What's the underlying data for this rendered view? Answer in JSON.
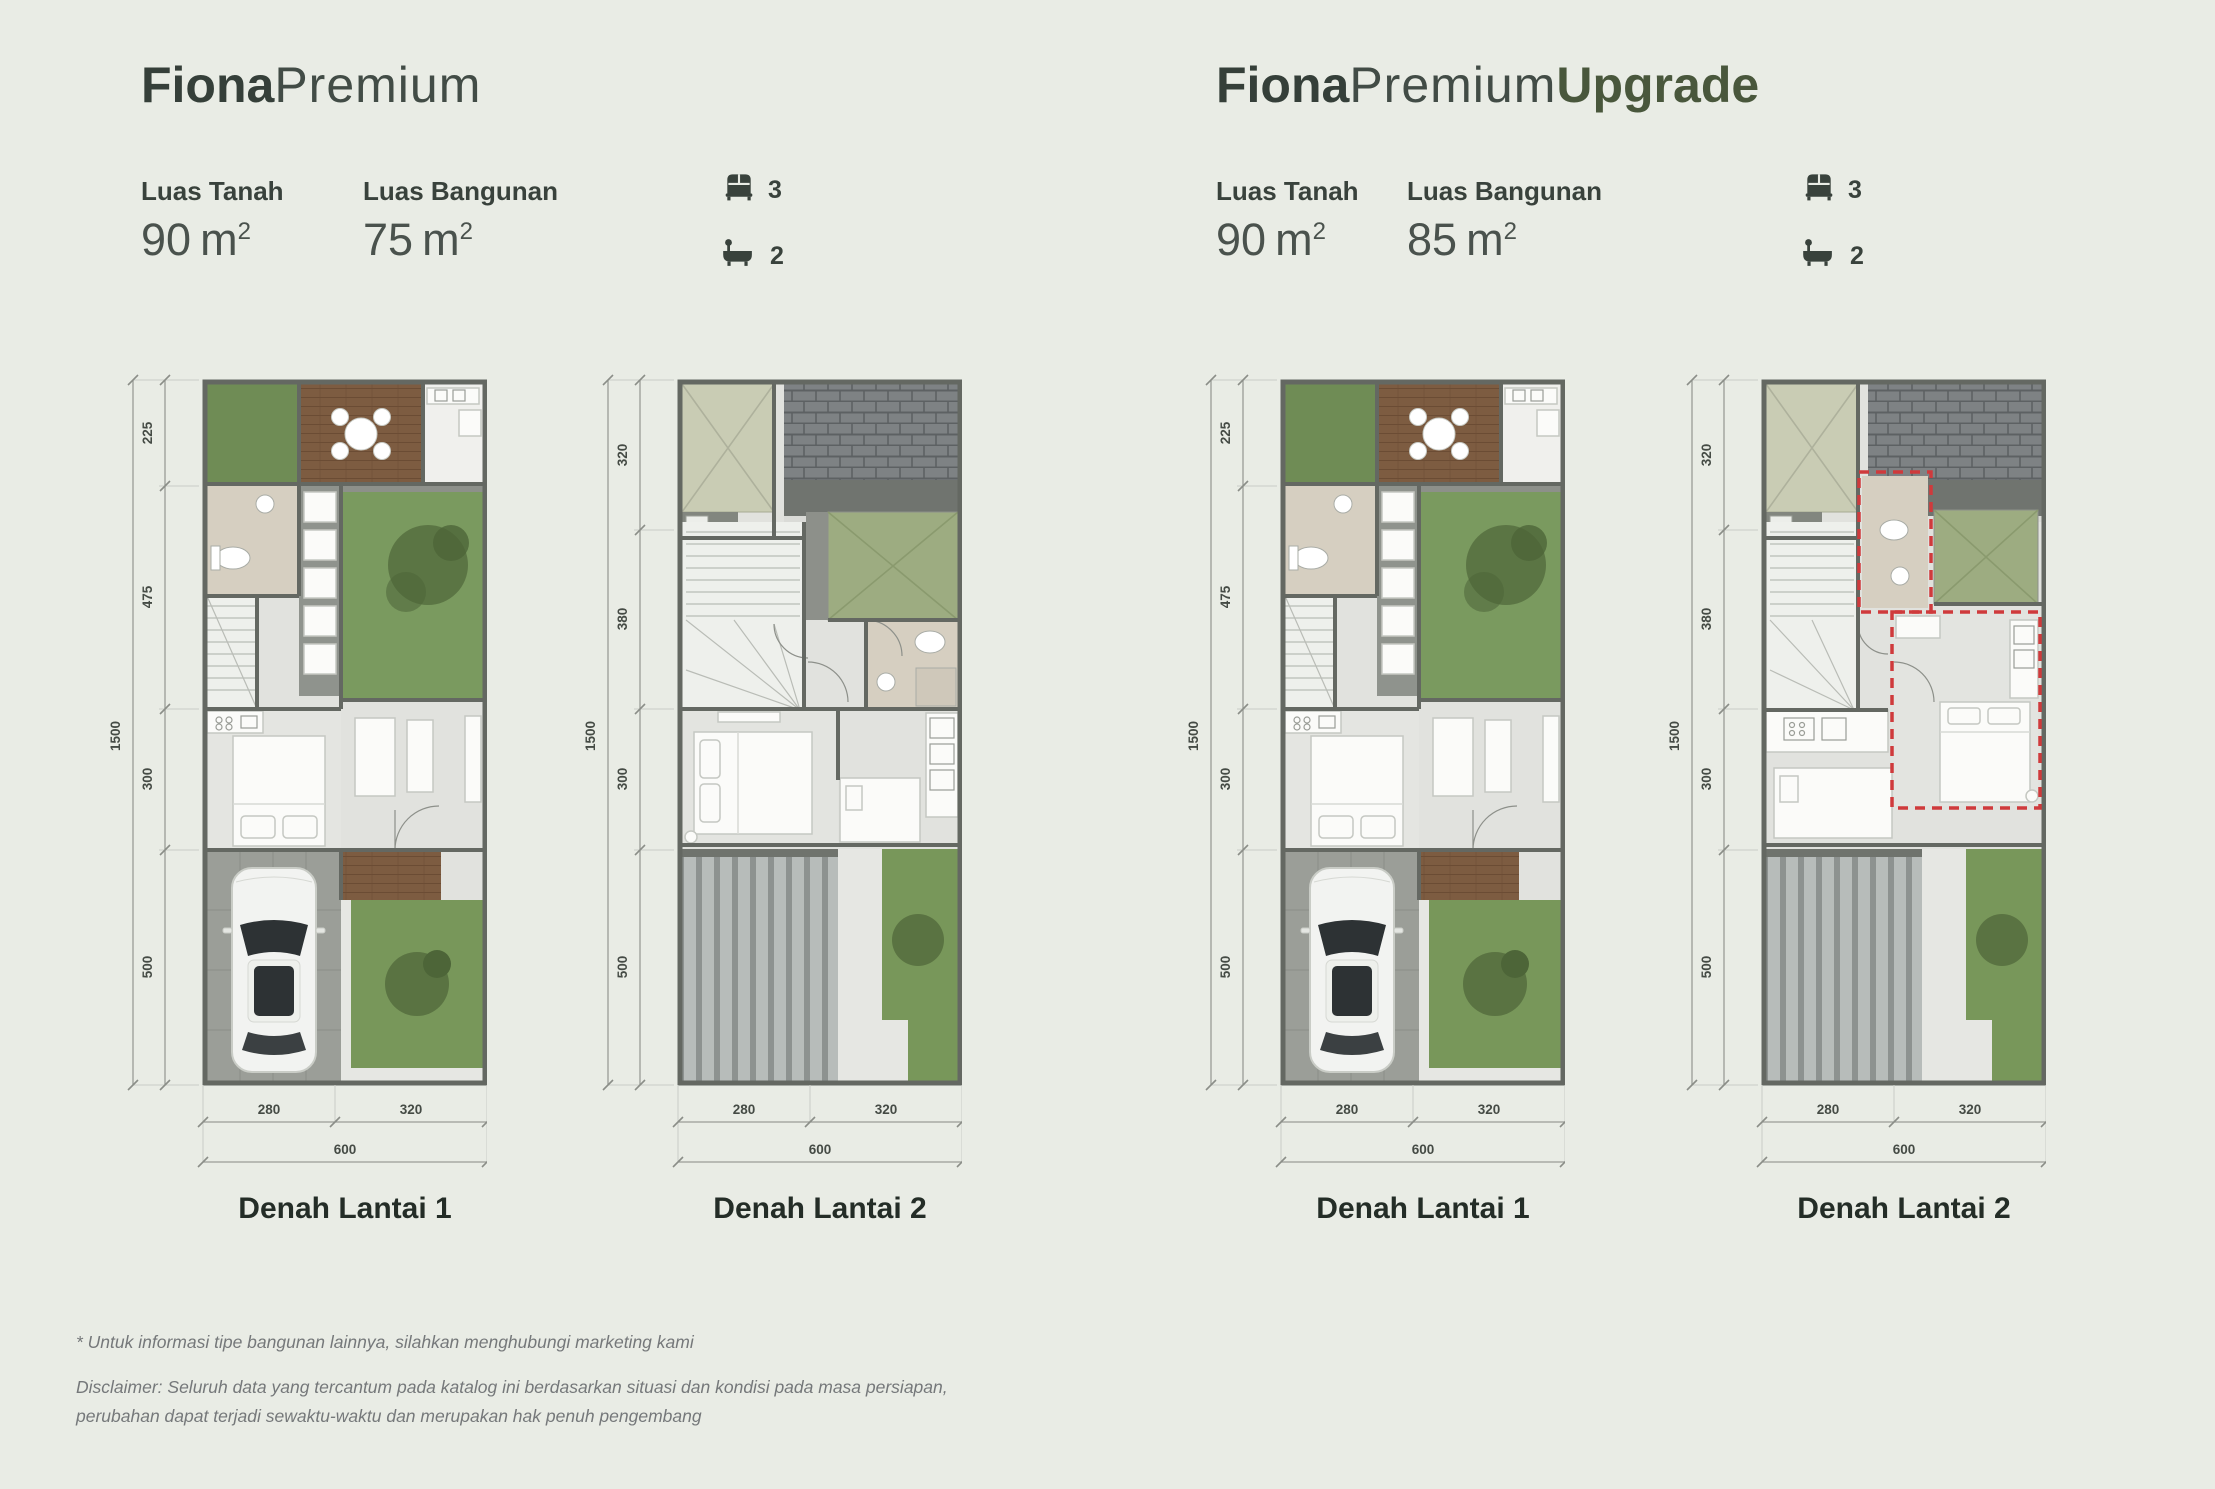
{
  "colors": {
    "background": "#e9ece5",
    "title_dark": "#353f39",
    "accent_green": "#49573c",
    "upgrade_dashed_outline": "#cf3a3c"
  },
  "sections": [
    {
      "id": "fiona-premium",
      "title": {
        "bold": "Fiona",
        "light": "Premium",
        "accent": ""
      },
      "specs": {
        "luas_tanah": {
          "label": "Luas Tanah",
          "num": "90",
          "unit": "m",
          "sup": "2"
        },
        "luas_bangunan": {
          "label": "Luas Bangunan",
          "num": "75",
          "unit": "m",
          "sup": "2"
        },
        "bedrooms": "3",
        "bathrooms": "2"
      },
      "floors": [
        {
          "label": "Denah Lantai 1",
          "dims_v": [
            "225",
            "475",
            "300",
            "500"
          ],
          "dims_v_total": "1500",
          "dims_h": [
            "280",
            "320"
          ],
          "dims_h_total": "600"
        },
        {
          "label": "Denah Lantai 2",
          "dims_v": [
            "320",
            "380",
            "300",
            "500"
          ],
          "dims_v_total": "1500",
          "dims_h": [
            "280",
            "320"
          ],
          "dims_h_total": "600"
        }
      ]
    },
    {
      "id": "fiona-premium-upgrade",
      "title": {
        "bold": "Fiona",
        "light": "Premium",
        "accent": "Upgrade"
      },
      "specs": {
        "luas_tanah": {
          "label": "Luas Tanah",
          "num": "90",
          "unit": "m",
          "sup": "2"
        },
        "luas_bangunan": {
          "label": "Luas Bangunan",
          "num": "85",
          "unit": "m",
          "sup": "2"
        },
        "bedrooms": "3",
        "bathrooms": "2"
      },
      "floors": [
        {
          "label": "Denah Lantai 1",
          "dims_v": [
            "225",
            "475",
            "300",
            "500"
          ],
          "dims_v_total": "1500",
          "dims_h": [
            "280",
            "320"
          ],
          "dims_h_total": "600"
        },
        {
          "label": "Denah Lantai 2",
          "dims_v": [
            "320",
            "380",
            "300",
            "500"
          ],
          "dims_v_total": "1500",
          "dims_h": [
            "280",
            "320"
          ],
          "dims_h_total": "600"
        }
      ]
    }
  ],
  "footer": {
    "note": "* Untuk informasi tipe bangunan lainnya, silahkan menghubungi marketing kami",
    "disclaimer1": "Disclaimer: Seluruh data yang tercantum pada katalog ini berdasarkan situasi dan kondisi pada masa persiapan,",
    "disclaimer2": "perubahan dapat terjadi sewaktu-waktu dan merupakan hak penuh pengembang"
  }
}
